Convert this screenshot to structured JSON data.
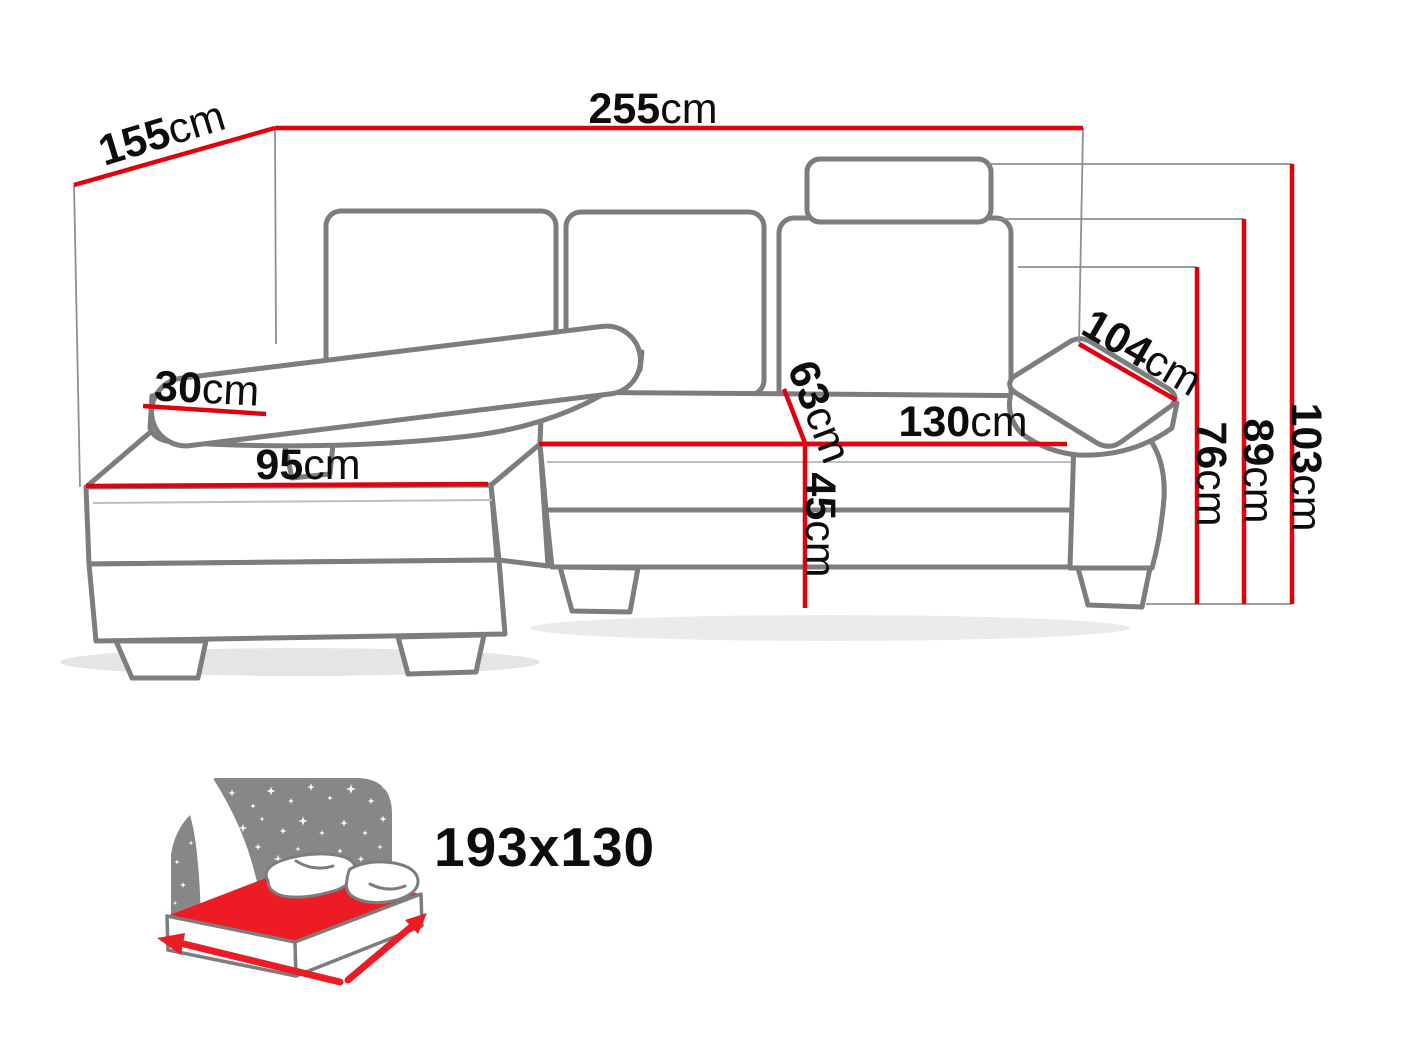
{
  "diagram": {
    "type": "corner-sofa-dimension-diagram",
    "measurements": {
      "total_width": {
        "value": "255",
        "unit": "cm"
      },
      "total_depth": {
        "value": "155",
        "unit": "cm"
      },
      "armrest_width": {
        "value": "30",
        "unit": "cm"
      },
      "chaise_length": {
        "value": "95",
        "unit": "cm"
      },
      "armrest_length": {
        "value": "104",
        "unit": "cm"
      },
      "seat_width": {
        "value": "130",
        "unit": "cm"
      },
      "seat_depth": {
        "value": "63",
        "unit": "cm"
      },
      "seat_height": {
        "value": "45",
        "unit": "cm"
      },
      "armrest_height": {
        "value": "76",
        "unit": "cm"
      },
      "backrest_height": {
        "value": "89",
        "unit": "cm"
      },
      "total_height": {
        "value": "103",
        "unit": "cm"
      }
    },
    "sleeping_area": {
      "size": "193x130"
    },
    "colors": {
      "dimension_red": "#e2000f",
      "sofa_outline_gray": "#7d7d7d",
      "guide_gray": "#8f8f8f",
      "icon_gray": "#878787",
      "icon_red": "#ed1c24",
      "label_black": "#0d0d0d"
    }
  }
}
